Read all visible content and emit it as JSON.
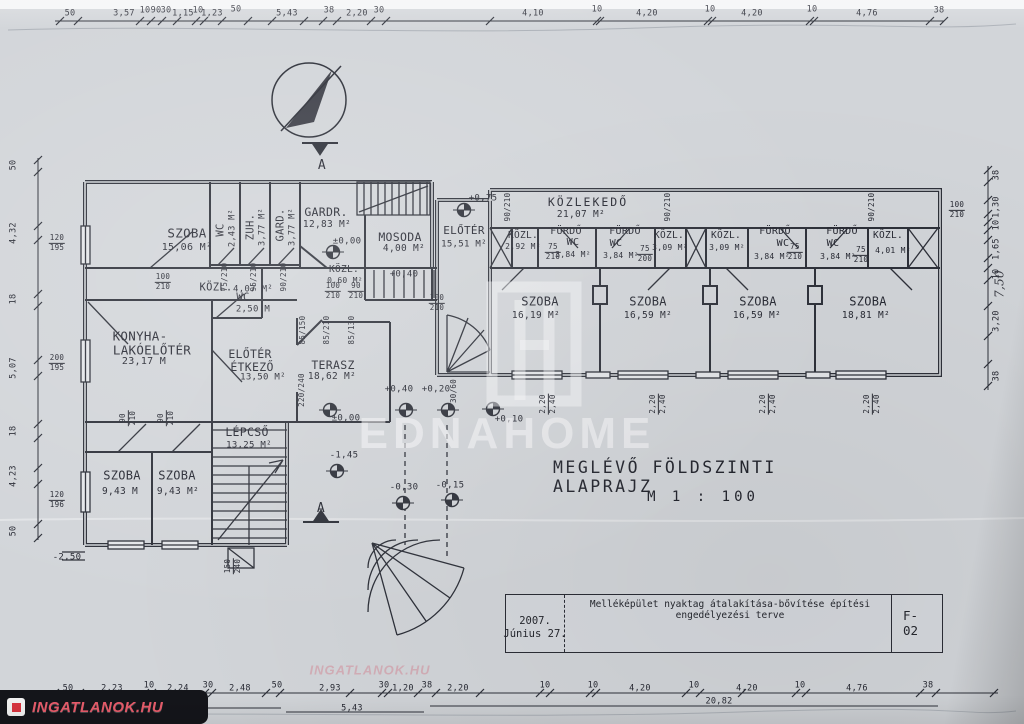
{
  "title": {
    "line1": "MEGLÉVŐ  FÖLDSZINTI  ALAPRAJZ",
    "line2": "M  1 : 100"
  },
  "title_block": {
    "description": "Melléképület nyaktag átalakítása-bővítése építési engedélyezési terve",
    "date1": "2007.",
    "date2": "Június 27.",
    "sheet": "F-02"
  },
  "watermarks": {
    "center_text": "EDNAHOME",
    "corner_text": "INGATLANOK.HU",
    "ghost_text": "INGATLANOK.HU"
  },
  "ink_color": "#2b2d36",
  "paper_color": "#d2d5d9",
  "rooms": [
    {
      "n1": {
        "t": "SZOBA",
        "x": 187,
        "y": 233,
        "s": 12.5
      },
      "ar": {
        "t": "15,06 M²",
        "x": 187,
        "y": 248,
        "s": 10
      }
    },
    {
      "n1": {
        "t": "WC",
        "x": 221,
        "y": 230,
        "s": 10.5,
        "r": -90
      },
      "ar": {
        "t": "2,43 M²",
        "x": 233,
        "y": 228,
        "s": 8.5,
        "r": -90
      }
    },
    {
      "n1": {
        "t": "ZUH.",
        "x": 251,
        "y": 227,
        "s": 10.5,
        "r": -90
      },
      "ar": {
        "t": "3,77 M²",
        "x": 263,
        "y": 227,
        "s": 8.5,
        "r": -90
      }
    },
    {
      "n1": {
        "t": "GARD.",
        "x": 281,
        "y": 225,
        "s": 10.5,
        "r": -90
      },
      "ar": {
        "t": "3,77 M²",
        "x": 293,
        "y": 227,
        "s": 8.5,
        "r": -90
      }
    },
    {
      "n1": {
        "t": "GARDR.",
        "x": 326,
        "y": 212,
        "s": 11.5
      },
      "ar": {
        "t": "12,83 M²",
        "x": 327,
        "y": 225,
        "s": 9.5
      }
    },
    {
      "n1": {
        "t": "MOSODA",
        "x": 400,
        "y": 237,
        "s": 11.5
      },
      "ar": {
        "t": "4,00 M²",
        "x": 404,
        "y": 249,
        "s": 9.5
      }
    },
    {
      "n1": {
        "t": "ELŐTÉR",
        "x": 464,
        "y": 231,
        "s": 11
      },
      "ar": {
        "t": "15,51 M²",
        "x": 464,
        "y": 245,
        "s": 9
      }
    },
    {
      "n1": {
        "t": "KÖZLEKEDŐ",
        "x": 588,
        "y": 202,
        "s": 11.5,
        "ls": 2
      },
      "ar": {
        "t": "21,07 M²",
        "x": 581,
        "y": 215,
        "s": 9.5
      }
    },
    {
      "n1": {
        "t": "KÖZL.",
        "x": 523,
        "y": 236,
        "s": 9.5
      },
      "ar": {
        "t": "2,92 M²",
        "x": 523,
        "y": 247,
        "s": 8
      }
    },
    {
      "n1": {
        "t": "FÜRDŐ",
        "x": 566,
        "y": 232,
        "s": 10
      },
      "n2": {
        "t": "WC",
        "x": 573,
        "y": 243,
        "s": 10
      },
      "ar": {
        "t": "3,84 M²",
        "x": 573,
        "y": 255,
        "s": 8
      }
    },
    {
      "n1": {
        "t": "FÜRDŐ",
        "x": 625,
        "y": 232,
        "s": 10
      },
      "n2": {
        "t": "WC",
        "x": 616,
        "y": 244,
        "s": 10
      },
      "ar": {
        "t": "3,84 M²",
        "x": 621,
        "y": 256,
        "s": 8
      }
    },
    {
      "n1": {
        "t": "KÖZL.",
        "x": 669,
        "y": 236,
        "s": 9.5
      },
      "ar": {
        "t": "3,09 M²",
        "x": 670,
        "y": 248,
        "s": 8
      }
    },
    {
      "n1": {
        "t": "KÖZL.",
        "x": 726,
        "y": 236,
        "s": 9.5
      },
      "ar": {
        "t": "3,09 M²",
        "x": 727,
        "y": 248,
        "s": 8
      }
    },
    {
      "n1": {
        "t": "FÜRDŐ",
        "x": 775,
        "y": 232,
        "s": 10
      },
      "n2": {
        "t": "WC",
        "x": 783,
        "y": 244,
        "s": 10
      },
      "ar": {
        "t": "3,84 M²",
        "x": 772,
        "y": 257,
        "s": 8
      }
    },
    {
      "n1": {
        "t": "FÜRDŐ",
        "x": 842,
        "y": 232,
        "s": 10
      },
      "n2": {
        "t": "WC",
        "x": 833,
        "y": 244,
        "s": 10
      },
      "ar": {
        "t": "3,84 M²",
        "x": 838,
        "y": 257,
        "s": 8
      }
    },
    {
      "n1": {
        "t": "KÖZL.",
        "x": 888,
        "y": 236,
        "s": 9.5
      },
      "ar": {
        "t": "4,01 M²",
        "x": 893,
        "y": 251,
        "s": 8
      }
    },
    {
      "n1": {
        "t": "SZOBA",
        "x": 540,
        "y": 302,
        "s": 12
      },
      "ar": {
        "t": "16,19 M²",
        "x": 536,
        "y": 316,
        "s": 9.5
      }
    },
    {
      "n1": {
        "t": "SZOBA",
        "x": 648,
        "y": 302,
        "s": 12
      },
      "ar": {
        "t": "16,59 M²",
        "x": 648,
        "y": 316,
        "s": 9.5
      }
    },
    {
      "n1": {
        "t": "SZOBA",
        "x": 758,
        "y": 302,
        "s": 12
      },
      "ar": {
        "t": "16,59 M²",
        "x": 757,
        "y": 316,
        "s": 9.5
      }
    },
    {
      "n1": {
        "t": "SZOBA",
        "x": 868,
        "y": 302,
        "s": 12
      },
      "ar": {
        "t": "18,81 M²",
        "x": 866,
        "y": 316,
        "s": 9.5
      }
    },
    {
      "n1": {
        "t": "KÖZL.",
        "x": 216,
        "y": 288,
        "s": 10.5
      },
      "ar": {
        "t": "4,07 M²",
        "x": 253,
        "y": 290,
        "s": 9
      }
    },
    {
      "n1": {
        "t": "KÖZL.",
        "x": 344,
        "y": 270,
        "s": 9.5
      },
      "ar": {
        "t": "0,60 M²",
        "x": 345,
        "y": 281,
        "s": 8
      }
    },
    {
      "n1": {
        "t": "WC",
        "x": 243,
        "y": 298,
        "s": 10.5
      },
      "ar": {
        "t": "2,50 M",
        "x": 253,
        "y": 310,
        "s": 9
      }
    },
    {
      "n1": {
        "t": "KONYHA-",
        "x": 140,
        "y": 336,
        "s": 12.5
      },
      "n2": {
        "t": "LAKÓELŐTÉR",
        "x": 152,
        "y": 350,
        "s": 12.5
      },
      "ar": {
        "t": "23,17 M",
        "x": 144,
        "y": 362,
        "s": 10
      }
    },
    {
      "n1": {
        "t": "ELŐTÉR",
        "x": 250,
        "y": 354,
        "s": 11.5
      },
      "n2": {
        "t": "ÉTKEZŐ",
        "x": 252,
        "y": 367,
        "s": 11.5
      },
      "ar": {
        "t": "13,50 M²",
        "x": 263,
        "y": 378,
        "s": 9
      }
    },
    {
      "n1": {
        "t": "TERASZ",
        "x": 333,
        "y": 365,
        "s": 11.5
      },
      "ar": {
        "t": "18,62 M²",
        "x": 332,
        "y": 377,
        "s": 9.5
      }
    },
    {
      "n1": {
        "t": "LÉPCSŐ",
        "x": 247,
        "y": 432,
        "s": 11.5
      },
      "ar": {
        "t": "13,25 M²",
        "x": 249,
        "y": 446,
        "s": 9
      }
    },
    {
      "n1": {
        "t": "SZOBA",
        "x": 122,
        "y": 476,
        "s": 12
      },
      "ar": {
        "t": "9,43 M",
        "x": 120,
        "y": 492,
        "s": 9.5
      }
    },
    {
      "n1": {
        "t": "SZOBA",
        "x": 177,
        "y": 476,
        "s": 12
      },
      "ar": {
        "t": "9,43 M²",
        "x": 178,
        "y": 492,
        "s": 9.5
      }
    }
  ],
  "levels": [
    {
      "t": "±0,00",
      "x": 347,
      "y": 242,
      "cx": 333,
      "cy": 252
    },
    {
      "t": "±0,00",
      "x": 346,
      "y": 419,
      "cx": 330,
      "cy": 410
    },
    {
      "t": "+0,75",
      "x": 483,
      "y": 199,
      "cx": 464,
      "cy": 210
    },
    {
      "t": "+0,40",
      "x": 404,
      "y": 275,
      "cx": -1,
      "cy": 0
    },
    {
      "t": "+0,40",
      "x": 399,
      "y": 390,
      "cx": 406,
      "cy": 410
    },
    {
      "t": "+0,20",
      "x": 436,
      "y": 390,
      "cx": 448,
      "cy": 410
    },
    {
      "t": "+0,10",
      "x": 509,
      "y": 420,
      "cx": 493,
      "cy": 409
    },
    {
      "t": "-0,30",
      "x": 404,
      "y": 488,
      "cx": 403,
      "cy": 503
    },
    {
      "t": "-0,15",
      "x": 450,
      "y": 486,
      "cx": 452,
      "cy": 500
    },
    {
      "t": "-1,45",
      "x": 344,
      "y": 456,
      "cx": 337,
      "cy": 471
    },
    {
      "t": "-2,50",
      "x": 67,
      "y": 558,
      "cx": -1,
      "cy": 0
    }
  ],
  "dims": {
    "top": [
      {
        "t": "50",
        "x": 70,
        "y": 14
      },
      {
        "t": "3,57",
        "x": 124,
        "y": 14
      },
      {
        "t": "10",
        "x": 145,
        "y": 11
      },
      {
        "t": "90",
        "x": 156,
        "y": 11
      },
      {
        "t": "30",
        "x": 166,
        "y": 11
      },
      {
        "t": "1,15",
        "x": 183,
        "y": 14
      },
      {
        "t": "10",
        "x": 198,
        "y": 11
      },
      {
        "t": "1,23",
        "x": 212,
        "y": 14
      },
      {
        "t": "50",
        "x": 236,
        "y": 10
      },
      {
        "t": "5,43",
        "x": 287,
        "y": 14
      },
      {
        "t": "38",
        "x": 329,
        "y": 11
      },
      {
        "t": "2,20",
        "x": 357,
        "y": 14
      },
      {
        "t": "30",
        "x": 379,
        "y": 11
      },
      {
        "t": "4,10",
        "x": 533,
        "y": 14
      },
      {
        "t": "10",
        "x": 597,
        "y": 10
      },
      {
        "t": "4,20",
        "x": 647,
        "y": 14
      },
      {
        "t": "10",
        "x": 710,
        "y": 10
      },
      {
        "t": "4,20",
        "x": 752,
        "y": 14
      },
      {
        "t": "10",
        "x": 812,
        "y": 10
      },
      {
        "t": "4,76",
        "x": 867,
        "y": 14
      },
      {
        "t": "38",
        "x": 939,
        "y": 11
      }
    ],
    "bottom": [
      {
        "t": "50",
        "x": 68,
        "y": 689
      },
      {
        "t": "2,23",
        "x": 112,
        "y": 689
      },
      {
        "t": "10",
        "x": 149,
        "y": 686
      },
      {
        "t": "2,24",
        "x": 178,
        "y": 689
      },
      {
        "t": "30",
        "x": 208,
        "y": 686
      },
      {
        "t": "2,48",
        "x": 240,
        "y": 689
      },
      {
        "t": "50",
        "x": 277,
        "y": 686
      },
      {
        "t": "2,93",
        "x": 330,
        "y": 689
      },
      {
        "t": "30",
        "x": 384,
        "y": 686
      },
      {
        "t": "1,20",
        "x": 403,
        "y": 689
      },
      {
        "t": "38",
        "x": 427,
        "y": 686
      },
      {
        "t": "2,20",
        "x": 458,
        "y": 689
      },
      {
        "t": "10",
        "x": 545,
        "y": 686
      },
      {
        "t": "10",
        "x": 593,
        "y": 686
      },
      {
        "t": "4,20",
        "x": 640,
        "y": 689
      },
      {
        "t": "10",
        "x": 694,
        "y": 686
      },
      {
        "t": "4,20",
        "x": 747,
        "y": 689
      },
      {
        "t": "10",
        "x": 800,
        "y": 686
      },
      {
        "t": "4,76",
        "x": 857,
        "y": 689
      },
      {
        "t": "38",
        "x": 928,
        "y": 686
      }
    ],
    "bottom2": [
      {
        "t": "8,35",
        "x": 172,
        "y": 704
      },
      {
        "t": "5,43",
        "x": 352,
        "y": 709
      },
      {
        "t": "20,82",
        "x": 719,
        "y": 702
      }
    ],
    "left": [
      {
        "t": "50",
        "y": 165
      },
      {
        "t": "4,32",
        "y": 233
      },
      {
        "t": "18",
        "y": 299
      },
      {
        "t": "5,07",
        "y": 368
      },
      {
        "t": "18",
        "y": 431
      },
      {
        "t": "4,23",
        "y": 476
      },
      {
        "t": "50",
        "y": 531
      }
    ],
    "right": [
      {
        "t": "38",
        "y": 175
      },
      {
        "t": "1,30",
        "y": 207
      },
      {
        "t": "10",
        "y": 225
      },
      {
        "t": "1,65",
        "y": 249
      },
      {
        "t": "10",
        "y": 274
      },
      {
        "t": "3,20",
        "y": 321
      },
      {
        "t": "38",
        "y": 376
      }
    ],
    "right_hand": {
      "t": "7,50",
      "x": 1000,
      "y": 284
    }
  },
  "stacks": [
    {
      "a": "120",
      "b": "195",
      "x": 57,
      "y": 243,
      "r": 0
    },
    {
      "a": "200",
      "b": "195",
      "x": 57,
      "y": 363,
      "r": 0
    },
    {
      "a": "120",
      "b": "196",
      "x": 57,
      "y": 500,
      "r": 0
    },
    {
      "a": "100",
      "b": "210",
      "x": 957,
      "y": 210,
      "r": 0
    },
    {
      "a": "100",
      "b": "210",
      "x": 163,
      "y": 282,
      "r": 0
    },
    {
      "a": "100",
      "b": "210",
      "x": 333,
      "y": 291,
      "r": 0
    },
    {
      "a": "90",
      "b": "210",
      "x": 356,
      "y": 291,
      "r": 0
    },
    {
      "a": "100",
      "b": "210",
      "x": 437,
      "y": 303,
      "r": 0
    },
    {
      "a": "150",
      "b": "240",
      "x": 233,
      "y": 566,
      "r": -90
    },
    {
      "a": "90",
      "b": "210",
      "x": 128,
      "y": 418,
      "r": -90
    },
    {
      "a": "90",
      "b": "210",
      "x": 166,
      "y": 418,
      "r": -90
    },
    {
      "a": "75",
      "b": "210",
      "x": 553,
      "y": 252,
      "r": 0
    },
    {
      "a": "75",
      "b": "200",
      "x": 645,
      "y": 254,
      "r": 0
    },
    {
      "a": "75",
      "b": "210",
      "x": 795,
      "y": 252,
      "r": 0
    },
    {
      "a": "75",
      "b": "210",
      "x": 861,
      "y": 255,
      "r": 0
    },
    {
      "a": "2,20",
      "b": "2,40",
      "x": 548,
      "y": 404,
      "r": -90
    },
    {
      "a": "2,20",
      "b": "2,40",
      "x": 658,
      "y": 404,
      "r": -90
    },
    {
      "a": "2,20",
      "b": "2,40",
      "x": 768,
      "y": 404,
      "r": -90
    },
    {
      "a": "2,20",
      "b": "2,40",
      "x": 872,
      "y": 404,
      "r": -90
    }
  ],
  "smalls": [
    {
      "t": "75/210",
      "x": 225,
      "y": 277,
      "r": -90
    },
    {
      "t": "95/210",
      "x": 254,
      "y": 277,
      "r": -90
    },
    {
      "t": "90/210",
      "x": 284,
      "y": 277,
      "r": -90
    },
    {
      "t": "90/210",
      "x": 508,
      "y": 207,
      "r": -90
    },
    {
      "t": "90/210",
      "x": 668,
      "y": 207,
      "r": -90
    },
    {
      "t": "90/210",
      "x": 872,
      "y": 207,
      "r": -90
    },
    {
      "t": "85/150",
      "x": 303,
      "y": 330,
      "r": -90
    },
    {
      "t": "85/210",
      "x": 327,
      "y": 330,
      "r": -90
    },
    {
      "t": "85/130",
      "x": 352,
      "y": 330,
      "r": -90
    },
    {
      "t": "220/240",
      "x": 302,
      "y": 390,
      "r": -90
    },
    {
      "t": "30/60",
      "x": 454,
      "y": 391,
      "r": -90
    }
  ],
  "sections": [
    {
      "t": "A",
      "x": 322,
      "y": 166
    },
    {
      "t": "A",
      "x": 321,
      "y": 509
    }
  ]
}
